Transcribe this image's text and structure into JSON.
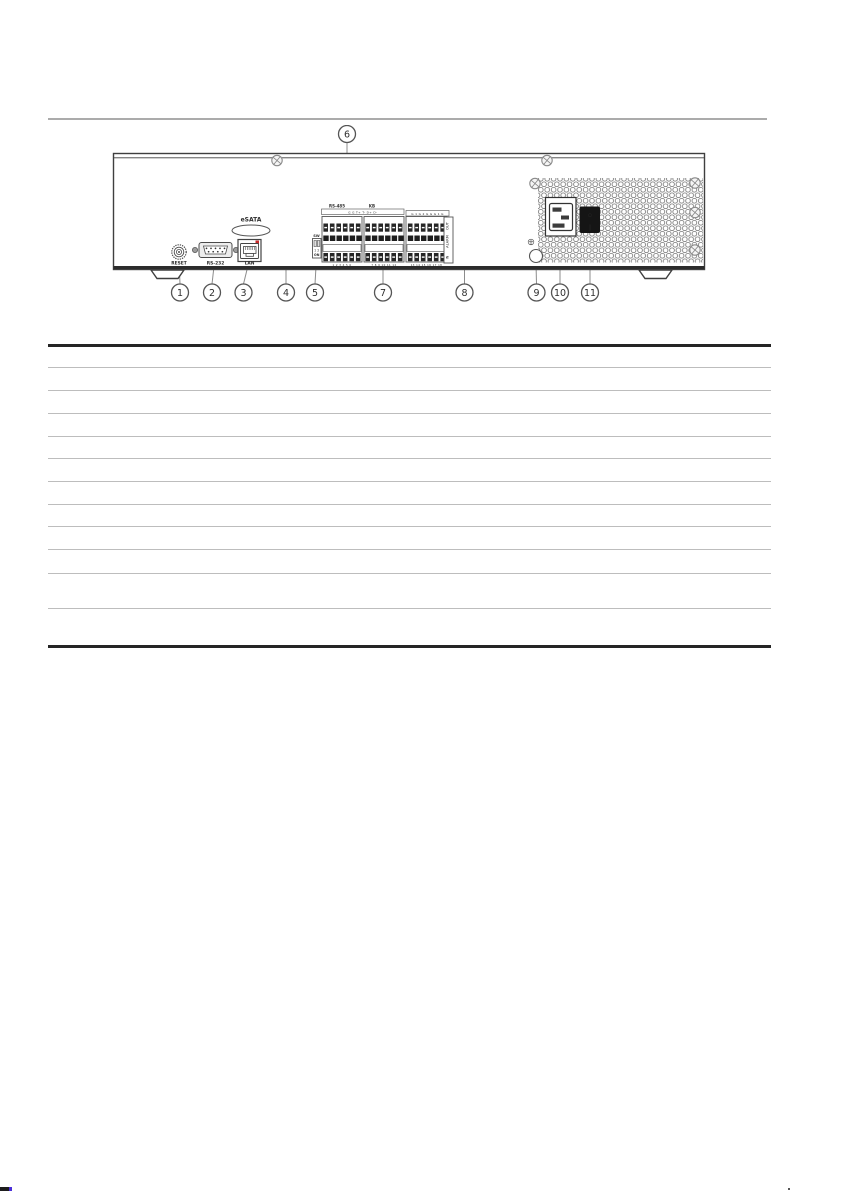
{
  "figure": {
    "callouts": [
      "1",
      "2",
      "3",
      "4",
      "5",
      "6",
      "7",
      "8",
      "9",
      "10",
      "11"
    ],
    "ports": {
      "reset": "RESET",
      "rs232": "RS-232",
      "lan": "LAN",
      "esata": "eSATA",
      "rs485": "RS-485",
      "kb": "KB",
      "sw": "SW",
      "sw_positions": "1 2",
      "sw_on": "ON",
      "alarm_out": "OUT",
      "alarm": "ALARM",
      "alarm_in": "IN",
      "serial_pins": "G G T+ T- D+ D-",
      "alarm_pins": "G 1 G 2 G G G 1 G",
      "terminal_numbers": [
        "1 2 3 4 5 6",
        "7 8 9 10 11 12",
        "13 14 15 16 17 18"
      ],
      "power_off_symbol": "○",
      "power_on_symbol": "|"
    }
  },
  "table": {
    "rows": [
      "",
      "",
      "",
      "",
      "",
      "",
      "",
      "",
      "",
      "",
      "",
      ""
    ]
  }
}
